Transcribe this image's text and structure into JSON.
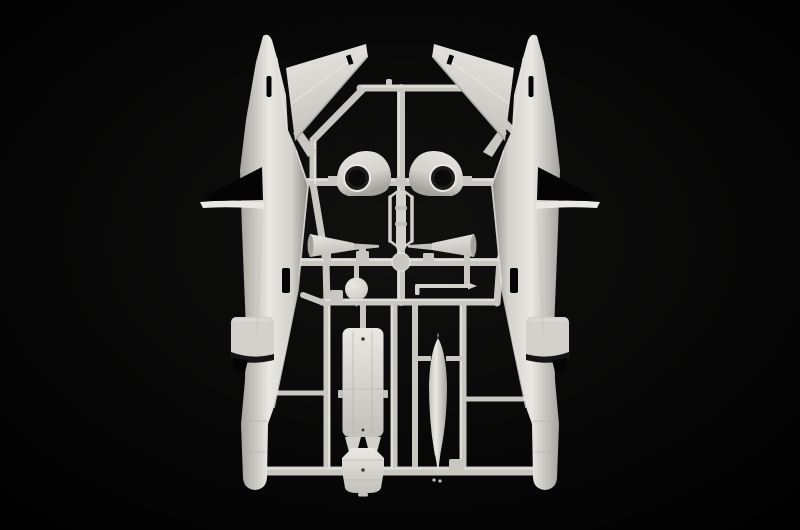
{
  "scene": {
    "label": "model-kit-sprue-photo",
    "subject": "grey plastic model aircraft sprue parts on black background"
  },
  "colors": {
    "background": "#000000",
    "plastic_light": "#e9e8e3",
    "plastic": "#d2d1cc",
    "plastic_mid": "#c2c1bc",
    "plastic_dark": "#a3a29d",
    "plastic_deep": "#8a8984",
    "runner": "#c8c7c2",
    "runner_light": "#e3e2dd",
    "hole": "#0a0a09",
    "cutout": "#040404"
  },
  "parts": {
    "left_fuselage": "left fuselage half",
    "right_fuselage": "right fuselage half",
    "left_wing": "left wing panel",
    "right_wing": "right wing panel",
    "cowl_left": "left engine cowl with opening",
    "cowl_right": "right engine cowl with opening",
    "cone_left": "left exhaust cone",
    "cone_right": "right exhaust cone",
    "ladder": "seat rail part",
    "ball": "ball joint part",
    "rod": "pitot rod part",
    "belly_panel": "belly panel part",
    "hatch_panel": "hatch panel part",
    "drop_tank": "drop tank part",
    "sprue_frame": "sprue runner frame",
    "bottom_bar": "bottom runner bar"
  }
}
